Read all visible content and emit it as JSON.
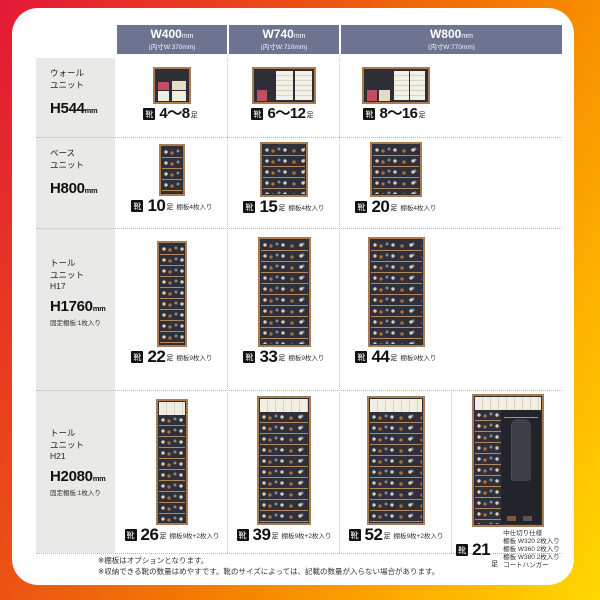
{
  "units": {
    "mm": "mm",
    "pairs": "足"
  },
  "icons": {
    "shoe": "靴"
  },
  "header": {
    "cols": [
      {
        "w": "W400",
        "inner": "(内寸W:370mm)"
      },
      {
        "w": "W740",
        "inner": "(内寸W:710mm)"
      },
      {
        "w": "W800",
        "inner": "(内寸W:770mm)"
      }
    ]
  },
  "rows": [
    {
      "label1": "ウォール",
      "label2": "ユニット",
      "label3": "",
      "height": "H544",
      "note": "",
      "cells": [
        {
          "count": "4〜8",
          "desc": ""
        },
        {
          "count": "6〜12",
          "desc": ""
        },
        {
          "count": "8〜16",
          "desc": ""
        }
      ]
    },
    {
      "label1": "ベース",
      "label2": "ユニット",
      "label3": "",
      "height": "H800",
      "note": "",
      "cells": [
        {
          "count": "10",
          "desc": "棚板4枚入り"
        },
        {
          "count": "15",
          "desc": "棚板4枚入り"
        },
        {
          "count": "20",
          "desc": "棚板4枚入り"
        }
      ]
    },
    {
      "label1": "トール",
      "label2": "ユニット",
      "label3": "H17",
      "height": "H1760",
      "note": "固定棚板:1枚入り",
      "cells": [
        {
          "count": "22",
          "desc": "棚板9枚入り"
        },
        {
          "count": "33",
          "desc": "棚板9枚入り"
        },
        {
          "count": "44",
          "desc": "棚板9枚入り"
        }
      ]
    },
    {
      "label1": "トール",
      "label2": "ユニット",
      "label3": "H21",
      "height": "H2080",
      "note": "固定棚板:1枚入り",
      "cells": [
        {
          "count": "26",
          "desc": "棚板9枚+2枚入り"
        },
        {
          "count": "39",
          "desc": "棚板9枚+2枚入り"
        },
        {
          "count": "52",
          "desc": "棚板9枚+2枚入り"
        },
        {
          "count": "21",
          "desc_lines": [
            "中仕切り仕様",
            "棚板 W320 2枚入り",
            "棚板 W360 2枚入り",
            "棚板 W380 2枚入り",
            "コートハンガー"
          ]
        }
      ]
    }
  ],
  "footnotes": [
    "※棚板はオプションとなります。",
    "※収納できる靴の数量はめやすです。靴のサイズによっては、記載の数量が入らない場合があります。"
  ],
  "colors": {
    "header_bg": "#6e7390",
    "label_col_bg": "#e9e9e7",
    "cabinet_frame": "#aa7b4e",
    "cabinet_interior": "#30303a",
    "bg_gradient": [
      "#e31837",
      "#f57f00",
      "#ffd900"
    ]
  }
}
